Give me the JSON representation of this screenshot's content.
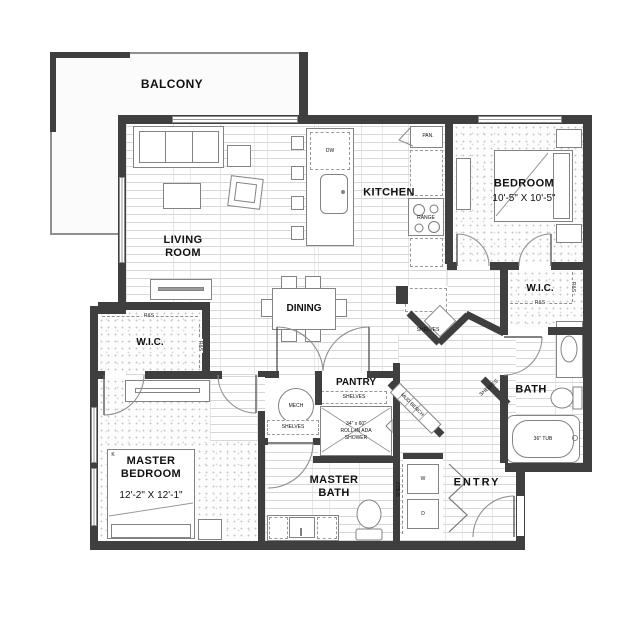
{
  "rooms": {
    "balcony": {
      "label": "BALCONY"
    },
    "living_room": {
      "label": "LIVING ROOM"
    },
    "kitchen": {
      "label": "KITCHEN"
    },
    "dining": {
      "label": "DINING"
    },
    "bedroom": {
      "label": "BEDROOM",
      "dims": "10'-5\" X 10'-5\""
    },
    "bedroom_wic": {
      "label": "W.I.C."
    },
    "bath": {
      "label": "BATH"
    },
    "pantry": {
      "label": "PANTRY"
    },
    "master_bedroom": {
      "label": "MASTER BEDROOM",
      "dims": "12'-2\" X 12'-1\""
    },
    "master_wic": {
      "label": "W.I.C."
    },
    "master_bath": {
      "label": "MASTER BATH"
    },
    "entry": {
      "label": "ENTRY"
    }
  },
  "fixtures": {
    "mech": "MECH",
    "dishwasher": "DW",
    "range": "RANGE",
    "pantry_cabinet": "PAN.",
    "shelves": "SHELVES",
    "rod_and_shelf": "R&S",
    "mud_bench": "MUD BENCH",
    "shelf": "SHELF",
    "washer": "W",
    "dryer": "D",
    "tub": "36\" TUB",
    "shower_size": "34\" x 60\"",
    "shower_type": "ROLL-IN ADA",
    "shower_word": "SHOWER",
    "bed_size_king": "K"
  },
  "colors": {
    "wall": "#3f3f3f",
    "fixture_line": "#838383",
    "floor_line": "#d7d7d7",
    "text": "#111111"
  }
}
